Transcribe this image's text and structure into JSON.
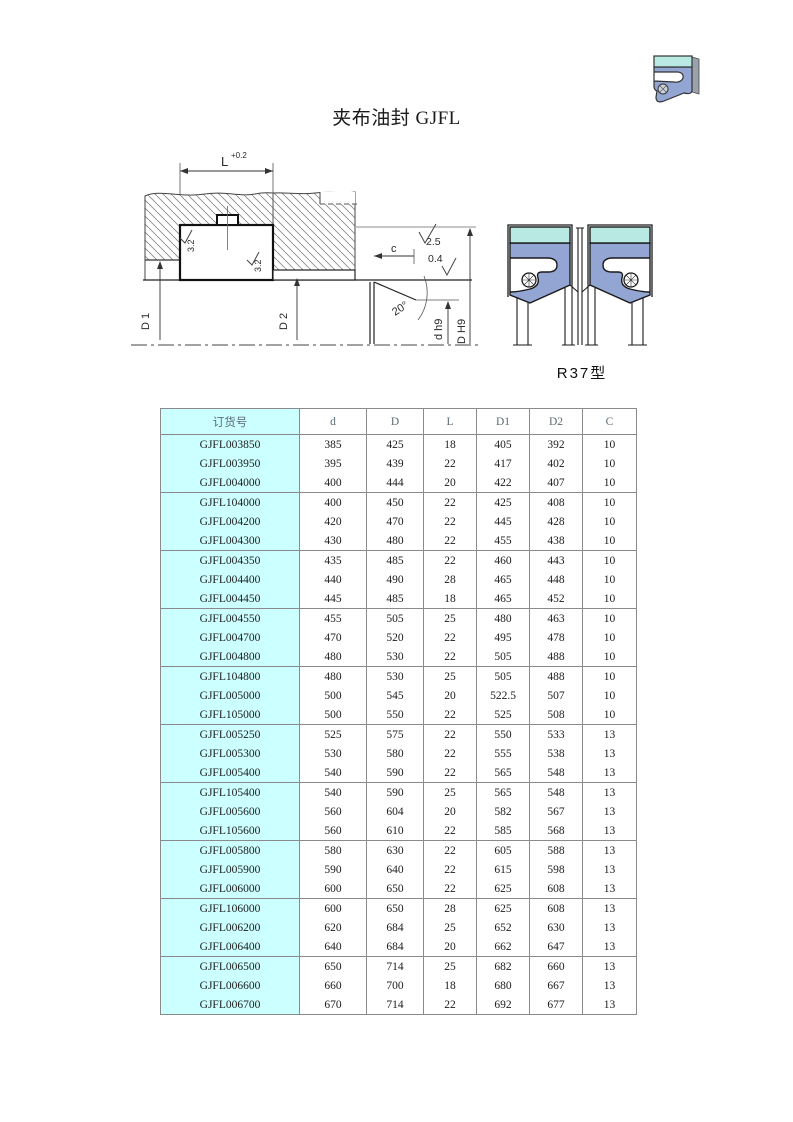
{
  "page": {
    "title": "夹布油封 GJFL"
  },
  "drawing": {
    "dim_l": "L",
    "dim_l_tol": "+0.2",
    "rough_seal_top": "3.2",
    "rough_seal_side": "3.2",
    "rough_bore": "2.5",
    "rough_shaft": "0.4",
    "dim_c": "c",
    "angle": "20°",
    "dim_d1": "D 1",
    "dim_d2": "D 2",
    "dim_shaft": "d h9",
    "dim_bore": "D H9"
  },
  "profile": {
    "label": "R37型"
  },
  "table": {
    "headers": [
      "订货号",
      "d",
      "D",
      "L",
      "D1",
      "D2",
      "C"
    ],
    "rows": [
      [
        "GJFL003850",
        "385",
        "425",
        "18",
        "405",
        "392",
        "10"
      ],
      [
        "GJFL003950",
        "395",
        "439",
        "22",
        "417",
        "402",
        "10"
      ],
      [
        "GJFL004000",
        "400",
        "444",
        "20",
        "422",
        "407",
        "10"
      ],
      [
        "GJFL104000",
        "400",
        "450",
        "22",
        "425",
        "408",
        "10"
      ],
      [
        "GJFL004200",
        "420",
        "470",
        "22",
        "445",
        "428",
        "10"
      ],
      [
        "GJFL004300",
        "430",
        "480",
        "22",
        "455",
        "438",
        "10"
      ],
      [
        "GJFL004350",
        "435",
        "485",
        "22",
        "460",
        "443",
        "10"
      ],
      [
        "GJFL004400",
        "440",
        "490",
        "28",
        "465",
        "448",
        "10"
      ],
      [
        "GJFL004450",
        "445",
        "485",
        "18",
        "465",
        "452",
        "10"
      ],
      [
        "GJFL004550",
        "455",
        "505",
        "25",
        "480",
        "463",
        "10"
      ],
      [
        "GJFL004700",
        "470",
        "520",
        "22",
        "495",
        "478",
        "10"
      ],
      [
        "GJFL004800",
        "480",
        "530",
        "22",
        "505",
        "488",
        "10"
      ],
      [
        "GJFL104800",
        "480",
        "530",
        "25",
        "505",
        "488",
        "10"
      ],
      [
        "GJFL005000",
        "500",
        "545",
        "20",
        "522.5",
        "507",
        "10"
      ],
      [
        "GJFL105000",
        "500",
        "550",
        "22",
        "525",
        "508",
        "10"
      ],
      [
        "GJFL005250",
        "525",
        "575",
        "22",
        "550",
        "533",
        "13"
      ],
      [
        "GJFL005300",
        "530",
        "580",
        "22",
        "555",
        "538",
        "13"
      ],
      [
        "GJFL005400",
        "540",
        "590",
        "22",
        "565",
        "548",
        "13"
      ],
      [
        "GJFL105400",
        "540",
        "590",
        "25",
        "565",
        "548",
        "13"
      ],
      [
        "GJFL005600",
        "560",
        "604",
        "20",
        "582",
        "567",
        "13"
      ],
      [
        "GJFL105600",
        "560",
        "610",
        "22",
        "585",
        "568",
        "13"
      ],
      [
        "GJFL005800",
        "580",
        "630",
        "22",
        "605",
        "588",
        "13"
      ],
      [
        "GJFL005900",
        "590",
        "640",
        "22",
        "615",
        "598",
        "13"
      ],
      [
        "GJFL006000",
        "600",
        "650",
        "22",
        "625",
        "608",
        "13"
      ],
      [
        "GJFL106000",
        "600",
        "650",
        "28",
        "625",
        "608",
        "13"
      ],
      [
        "GJFL006200",
        "620",
        "684",
        "25",
        "652",
        "630",
        "13"
      ],
      [
        "GJFL006400",
        "640",
        "684",
        "20",
        "662",
        "647",
        "13"
      ],
      [
        "GJFL006500",
        "650",
        "714",
        "25",
        "682",
        "660",
        "13"
      ],
      [
        "GJFL006600",
        "660",
        "700",
        "18",
        "680",
        "667",
        "13"
      ],
      [
        "GJFL006700",
        "670",
        "714",
        "22",
        "692",
        "677",
        "13"
      ]
    ]
  },
  "colors": {
    "table_accent": "#ccffff",
    "profile_fabric": "#b9e9e3",
    "profile_rubber": "#93a5d2",
    "line_color": "#1a1a1a"
  }
}
